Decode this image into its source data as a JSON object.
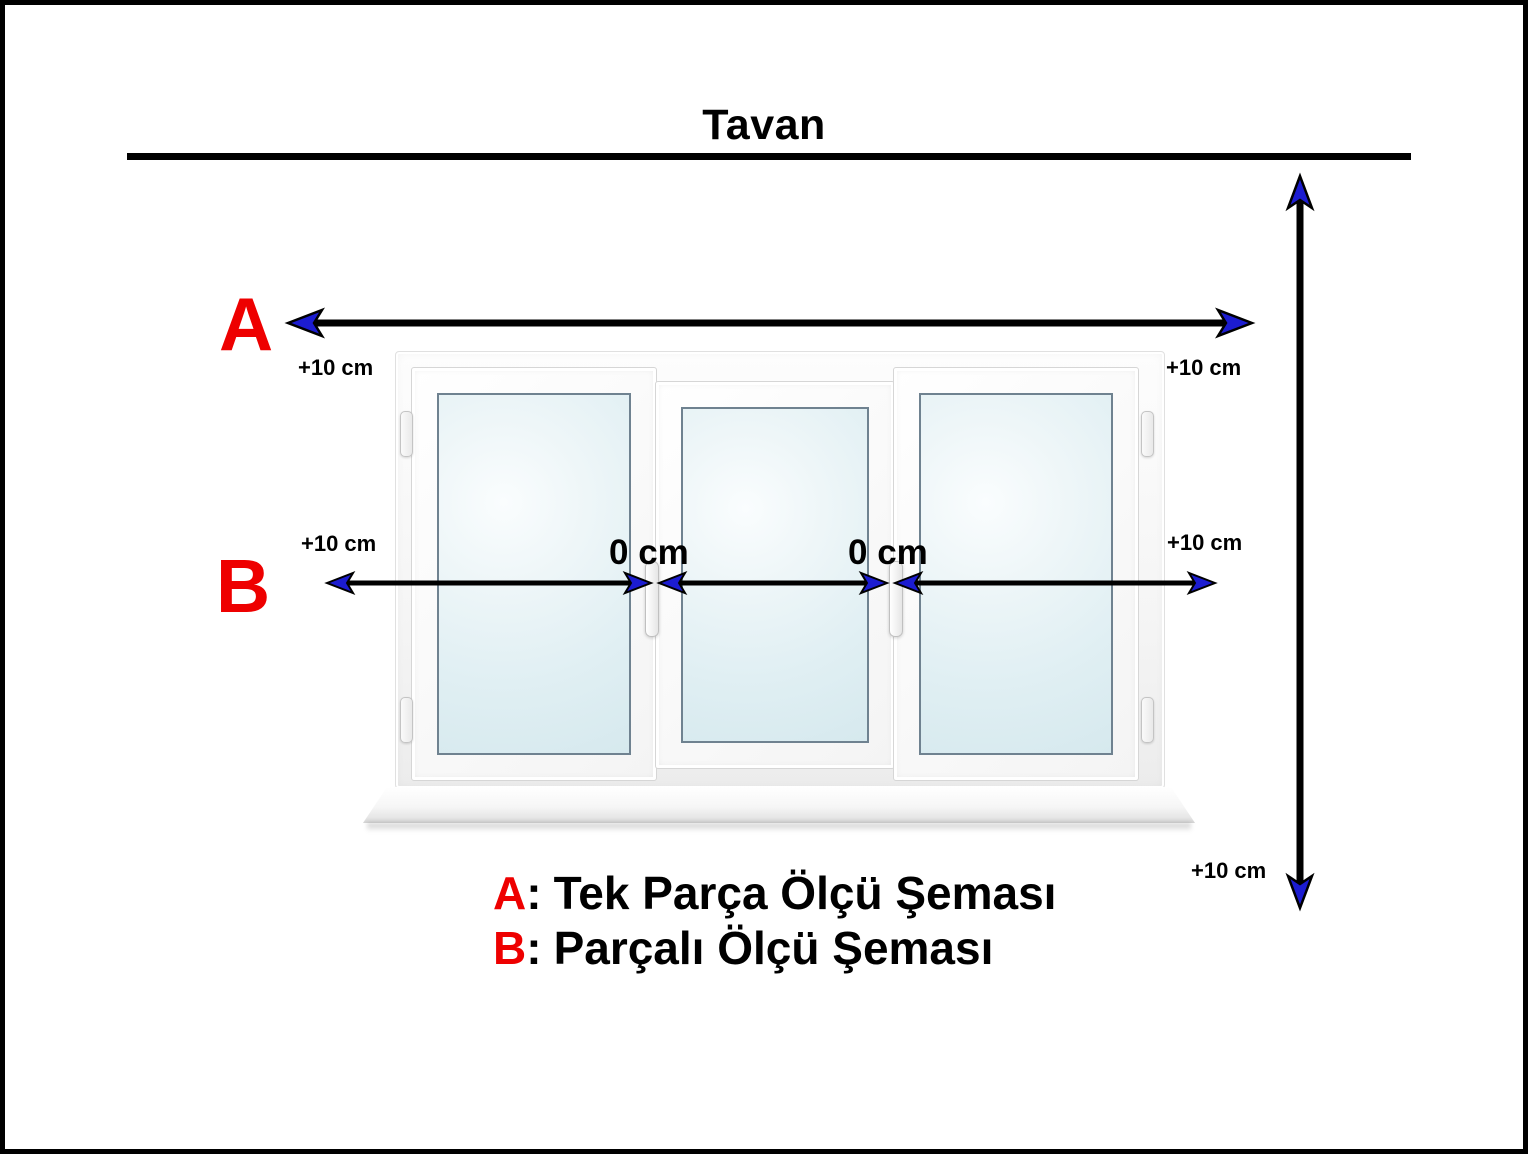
{
  "page": {
    "background": "#ffffff",
    "border_color": "#000000"
  },
  "title": {
    "text": "Tavan"
  },
  "measure_a": {
    "label": "A",
    "left_offset": "+10 cm",
    "right_offset": "+10 cm"
  },
  "measure_b": {
    "label": "B",
    "left_offset": "+10 cm",
    "gap_left": "0 cm",
    "gap_right": "0 cm",
    "right_offset": "+10 cm"
  },
  "measure_height": {
    "bottom_offset": "+10 cm"
  },
  "legend": {
    "line_a": {
      "key": "A",
      "colon": ":",
      "text": "Tek Parça Ölçü Şeması"
    },
    "line_b": {
      "key": "B",
      "colon": ":",
      "text": "Parçalı Ölçü Şeması"
    }
  },
  "colors": {
    "accent_red": "#ee0000",
    "arrow_black": "#000000",
    "arrowhead_blue": "#1c1cd1",
    "glass_blue": "#e0eff3"
  }
}
